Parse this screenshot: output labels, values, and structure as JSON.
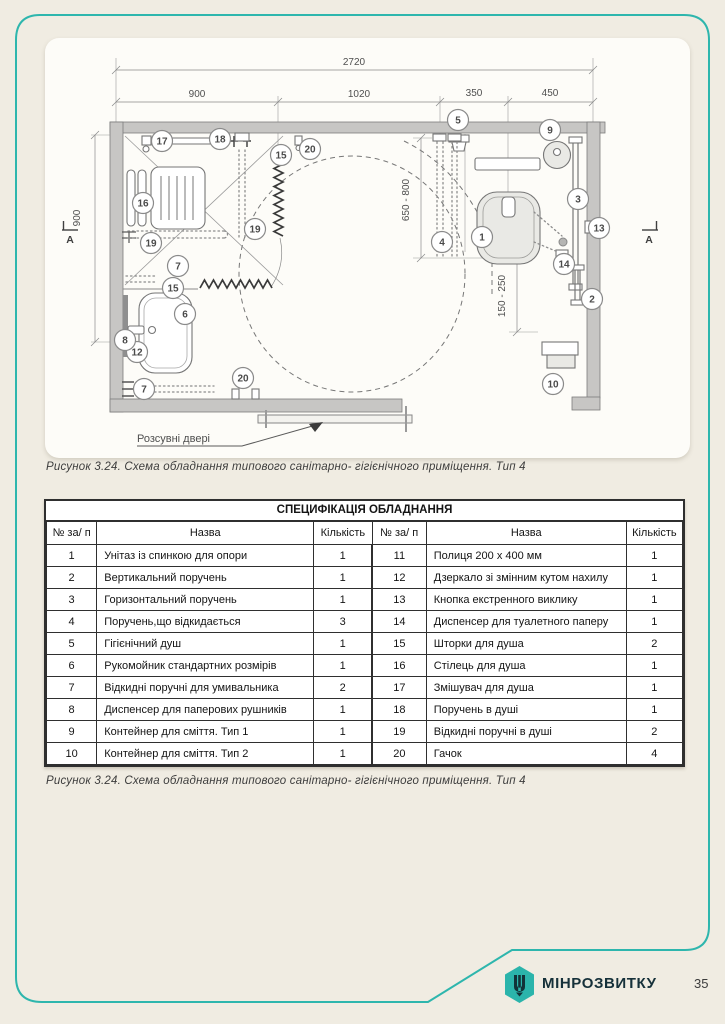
{
  "figure": {
    "caption_top": "Рисунок 3.24. Схема обладнання  типового санітарно- гігієнічного приміщення. Тип 4",
    "caption_bottom": "Рисунок 3.24. Схема обладнання  типового санітарно- гігієнічного приміщення. Тип 4",
    "door_label": "Розсувні двері",
    "section_marker": "А",
    "dimensions": {
      "overall": "2720",
      "seg1": "900",
      "seg2": "1020",
      "seg3": "350",
      "seg4": "450",
      "left": "900",
      "depth": "650 - 800",
      "front": "150 - 250"
    },
    "balloons": [
      {
        "n": "17",
        "x": 162,
        "y": 141
      },
      {
        "n": "18",
        "x": 220,
        "y": 139
      },
      {
        "n": "15",
        "x": 281,
        "y": 155
      },
      {
        "n": "20",
        "x": 310,
        "y": 149
      },
      {
        "n": "5",
        "x": 458,
        "y": 120
      },
      {
        "n": "9",
        "x": 550,
        "y": 130
      },
      {
        "n": "16",
        "x": 143,
        "y": 203
      },
      {
        "n": "19",
        "x": 255,
        "y": 229
      },
      {
        "n": "19",
        "x": 151,
        "y": 243
      },
      {
        "n": "3",
        "x": 578,
        "y": 199
      },
      {
        "n": "13",
        "x": 599,
        "y": 228
      },
      {
        "n": "1",
        "x": 482,
        "y": 237
      },
      {
        "n": "4",
        "x": 442,
        "y": 242
      },
      {
        "n": "14",
        "x": 564,
        "y": 264
      },
      {
        "n": "2",
        "x": 592,
        "y": 299
      },
      {
        "n": "7",
        "x": 178,
        "y": 266
      },
      {
        "n": "15",
        "x": 173,
        "y": 288
      },
      {
        "n": "6",
        "x": 185,
        "y": 314
      },
      {
        "n": "12",
        "x": 137,
        "y": 352
      },
      {
        "n": "8",
        "x": 125,
        "y": 340
      },
      {
        "n": "7",
        "x": 144,
        "y": 389
      },
      {
        "n": "20",
        "x": 243,
        "y": 378
      },
      {
        "n": "10",
        "x": 553,
        "y": 384
      }
    ]
  },
  "table": {
    "title": "СПЕЦИФІКАЦІЯ ОБЛАДНАННЯ",
    "headers": [
      "№ за/ п",
      "Назва",
      "Кількість",
      "№ за/ п",
      "Назва",
      "Кількість"
    ],
    "rows": [
      [
        "1",
        "Унітаз із спинкою для опори",
        "1",
        "11",
        "Полиця 200 х 400  мм",
        "1"
      ],
      [
        "2",
        "Вертикальний поручень",
        "1",
        "12",
        "Дзеркало зі змінним кутом нахилу",
        "1"
      ],
      [
        "3",
        "Горизонтальний поручень",
        "1",
        "13",
        "Кнопка екстренного виклику",
        "1"
      ],
      [
        "4",
        "Поручень,що відкидається",
        "3",
        "14",
        "Диспенсер для туалетного паперу",
        "1"
      ],
      [
        "5",
        "Гігієнічний душ",
        "1",
        "15",
        "Шторки для душа",
        "2"
      ],
      [
        "6",
        "Рукомойник стандартних розмірів",
        "1",
        "16",
        "Стілець для душа",
        "1"
      ],
      [
        "7",
        "Відкидні поручні для умивальника",
        "2",
        "17",
        "Змішувач для душа",
        "1"
      ],
      [
        "8",
        "Диспенсер для паперових рушників",
        "1",
        "18",
        "Поручень в душі",
        "1"
      ],
      [
        "9",
        "Контейнер для сміття. Тип 1",
        "1",
        "19",
        "Відкидні поручні в душі",
        "2"
      ],
      [
        "10",
        "Контейнер для сміття. Тип 2",
        "1",
        "20",
        "Гачок",
        "4"
      ]
    ]
  },
  "footer": {
    "logo_text": "МІНРОЗВИТКУ",
    "page_number": "35"
  },
  "colors": {
    "accent_teal": "#2eb6ad",
    "page_background": "#f0ece2",
    "wall_gray": "#c7c6c4"
  }
}
